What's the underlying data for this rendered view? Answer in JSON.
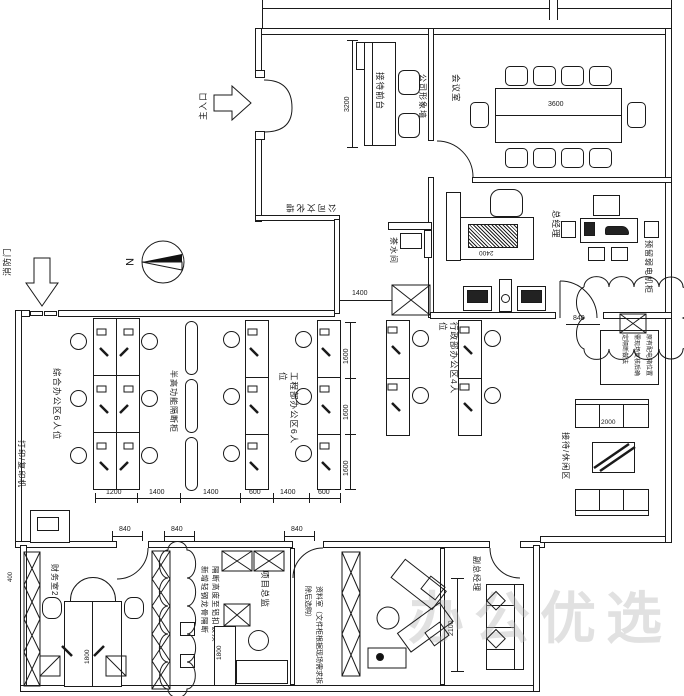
{
  "watermark": "办公优选",
  "compass": {
    "north": "N"
  },
  "entrances": {
    "main": "主入口",
    "fire": "消防门"
  },
  "rooms": {
    "reception": "接待前台",
    "image_wall": "公司形象墙",
    "culture_wall": "公司文化墙",
    "meeting": "会议室",
    "general_manager": "总经理",
    "weak_current": "预留弱电机柜",
    "tea": "茶水间",
    "printer": "打印/复印机",
    "zone_general": "综合办公区6人位",
    "partition_cabinet": "半高功能隔断柜",
    "zone_engineering": "工程部办公区6人位",
    "zone_admin": "行政部办公区4人位",
    "lounge": "接待/休闲区",
    "finance": "财务室2人位",
    "project_director": "项目总监",
    "archive": "资料室（文件柜根据现场需求拆除后选购）",
    "deputy_gm": "副总经理"
  },
  "notes": {
    "partition_line1": "新增轻钢龙骨隔断",
    "partition_line2": "隔断高度至铝扣板顶",
    "site_note": "原有配电箱位置需现场复核后确定隔断做法"
  },
  "dims": {
    "reception_depth": "3200",
    "conference_table": "3600",
    "gm_desk": "2400",
    "corridor": "1400",
    "desk_row": [
      "1200",
      "1400",
      "1400",
      "600",
      "1400",
      "600"
    ],
    "bay_depths": [
      "1600",
      "1600",
      "1600"
    ],
    "lounge_sofa": "2000",
    "deputy_room": "2100",
    "pd_desk": "1800",
    "finance_desk": "1800",
    "finance_cabinet": "400",
    "doors": [
      "840",
      "840",
      "840"
    ],
    "entry_door": "840"
  }
}
